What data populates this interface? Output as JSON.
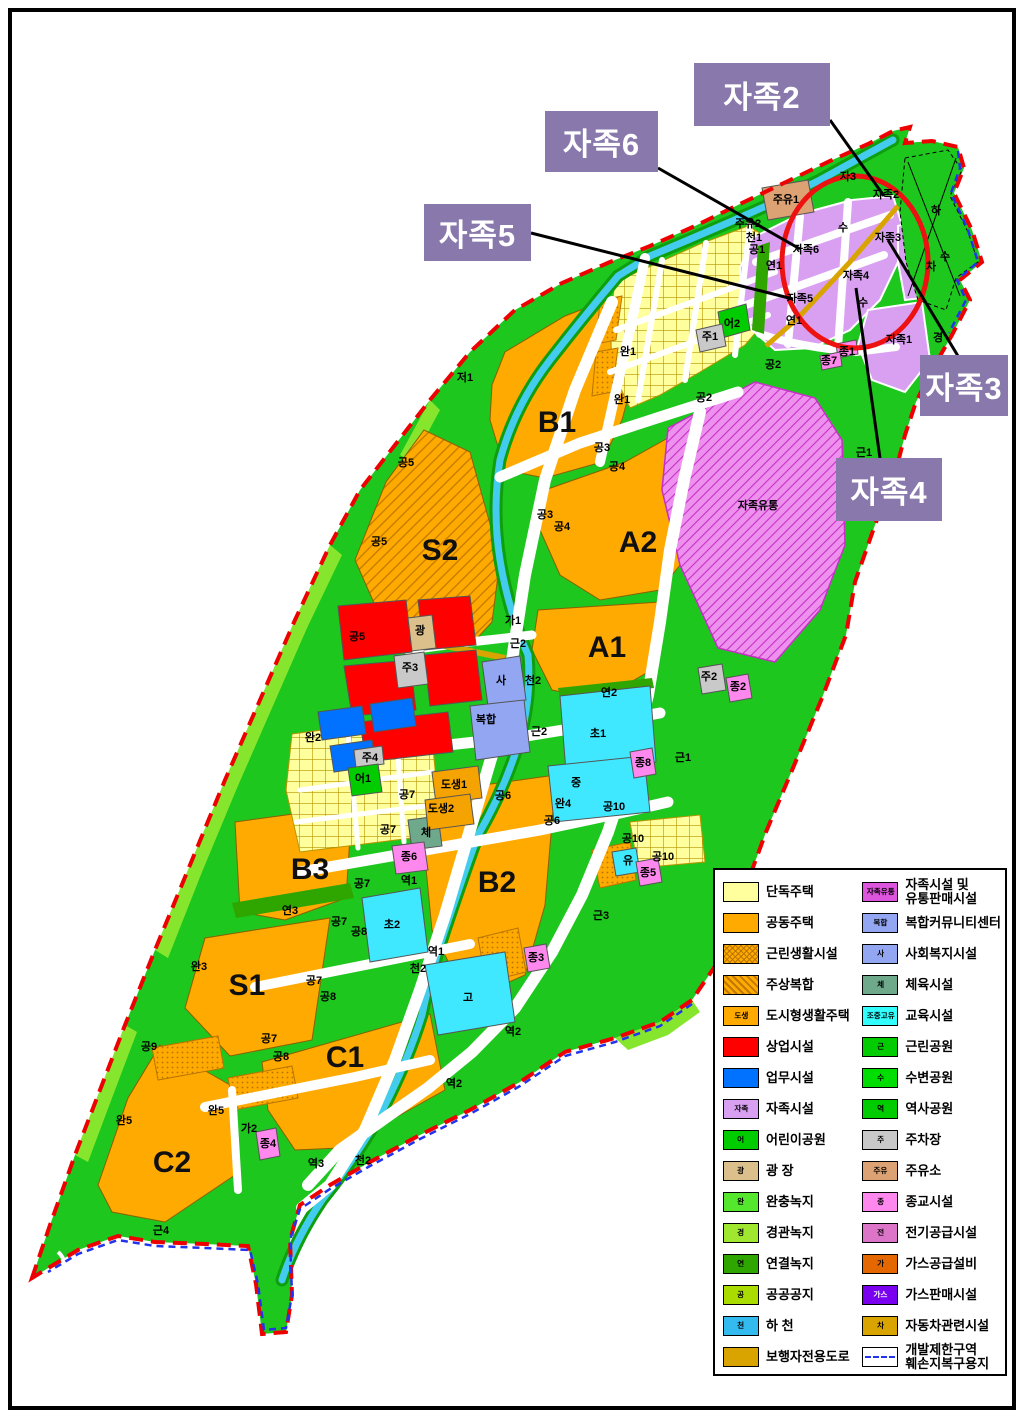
{
  "page": {
    "background": "#FFFFFF",
    "border_color": "#000000"
  },
  "callouts": [
    {
      "label": "자족2"
    },
    {
      "label": "자족6"
    },
    {
      "label": "자족5"
    },
    {
      "label": "자족3"
    },
    {
      "label": "자족4"
    }
  ],
  "map": {
    "colors": {
      "base_green": "#1DC71D",
      "light_green": "#86E62E",
      "orange": "#FFAA00",
      "pale_yellow": "#FFFF9E",
      "commercial_red": "#FF0000",
      "office_blue": "#0072FF",
      "school_cyan": "#3FE8FF",
      "stream_cyan": "#44CCEE",
      "jajok_purple": "#D9A0F2",
      "jajok_magenta": "#DD55DD",
      "community_periwinkle": "#92A6F2",
      "religion_pink": "#FF88EE",
      "plaza_tan": "#DCC08C",
      "gasstation_tan": "#DCA274",
      "parking_gray": "#C9C9C9",
      "gold_road": "#D9A400",
      "sports_teal": "#6FA98C",
      "link_green": "#2FA500",
      "boundary_red": "#EE0000",
      "boundary_blue": "#2233EE",
      "callout_bg": "#8878AC",
      "circle_red": "#EE1111"
    },
    "zone_letters": [
      {
        "t": "B1",
        "x": 557,
        "y": 432
      },
      {
        "t": "A2",
        "x": 638,
        "y": 552
      },
      {
        "t": "A1",
        "x": 607,
        "y": 657
      },
      {
        "t": "S2",
        "x": 440,
        "y": 560
      },
      {
        "t": "B2",
        "x": 497,
        "y": 892
      },
      {
        "t": "B3",
        "x": 310,
        "y": 879
      },
      {
        "t": "S1",
        "x": 247,
        "y": 995
      },
      {
        "t": "C1",
        "x": 345,
        "y": 1067
      },
      {
        "t": "C2",
        "x": 172,
        "y": 1172
      }
    ],
    "labels": [
      {
        "t": "자3",
        "x": 848,
        "y": 180
      },
      {
        "t": "주유1",
        "x": 786,
        "y": 203
      },
      {
        "t": "주유2",
        "x": 748,
        "y": 227
      },
      {
        "t": "천1",
        "x": 754,
        "y": 241
      },
      {
        "t": "공1",
        "x": 757,
        "y": 253
      },
      {
        "t": "하",
        "x": 936,
        "y": 214
      },
      {
        "t": "수",
        "x": 843,
        "y": 231
      },
      {
        "t": "수",
        "x": 945,
        "y": 260
      },
      {
        "t": "차",
        "x": 931,
        "y": 270
      },
      {
        "t": "경",
        "x": 938,
        "y": 341
      },
      {
        "t": "자족2",
        "x": 886,
        "y": 198
      },
      {
        "t": "자족3",
        "x": 888,
        "y": 241
      },
      {
        "t": "자족6",
        "x": 806,
        "y": 253
      },
      {
        "t": "자족4",
        "x": 856,
        "y": 279
      },
      {
        "t": "자족5",
        "x": 800,
        "y": 302
      },
      {
        "t": "자족1",
        "x": 899,
        "y": 343
      },
      {
        "t": "연1",
        "x": 774,
        "y": 269
      },
      {
        "t": "연1",
        "x": 794,
        "y": 324
      },
      {
        "t": "종1",
        "x": 847,
        "y": 355
      },
      {
        "t": "종7",
        "x": 829,
        "y": 364
      },
      {
        "t": "근1",
        "x": 864,
        "y": 456
      },
      {
        "t": "자족유통",
        "x": 758,
        "y": 509
      },
      {
        "t": "저1",
        "x": 465,
        "y": 381
      },
      {
        "t": "완1",
        "x": 628,
        "y": 355
      },
      {
        "t": "완1",
        "x": 622,
        "y": 403
      },
      {
        "t": "공3",
        "x": 602,
        "y": 451
      },
      {
        "t": "공4",
        "x": 617,
        "y": 470
      },
      {
        "t": "공3",
        "x": 545,
        "y": 518
      },
      {
        "t": "공4",
        "x": 562,
        "y": 530
      },
      {
        "t": "공2",
        "x": 773,
        "y": 368
      },
      {
        "t": "공2",
        "x": 704,
        "y": 401
      },
      {
        "t": "주1",
        "x": 710,
        "y": 340
      },
      {
        "t": "어2",
        "x": 732,
        "y": 327
      },
      {
        "t": "공5",
        "x": 406,
        "y": 466
      },
      {
        "t": "공5",
        "x": 379,
        "y": 545
      },
      {
        "t": "공5",
        "x": 357,
        "y": 640
      },
      {
        "t": "광",
        "x": 420,
        "y": 634
      },
      {
        "t": "주3",
        "x": 410,
        "y": 671
      },
      {
        "t": "완2",
        "x": 313,
        "y": 741
      },
      {
        "t": "주4",
        "x": 370,
        "y": 761
      },
      {
        "t": "어1",
        "x": 363,
        "y": 782
      },
      {
        "t": "공7",
        "x": 407,
        "y": 798
      },
      {
        "t": "가1",
        "x": 513,
        "y": 624
      },
      {
        "t": "근2",
        "x": 518,
        "y": 647
      },
      {
        "t": "사",
        "x": 501,
        "y": 684
      },
      {
        "t": "복합",
        "x": 486,
        "y": 723
      },
      {
        "t": "천2",
        "x": 533,
        "y": 684
      },
      {
        "t": "근2",
        "x": 539,
        "y": 735
      },
      {
        "t": "초1",
        "x": 598,
        "y": 737
      },
      {
        "t": "연2",
        "x": 609,
        "y": 696
      },
      {
        "t": "중",
        "x": 576,
        "y": 786
      },
      {
        "t": "종8",
        "x": 643,
        "y": 766
      },
      {
        "t": "근1",
        "x": 683,
        "y": 761
      },
      {
        "t": "도생1",
        "x": 454,
        "y": 788
      },
      {
        "t": "도생2",
        "x": 441,
        "y": 812
      },
      {
        "t": "공6",
        "x": 503,
        "y": 799
      },
      {
        "t": "완4",
        "x": 563,
        "y": 807
      },
      {
        "t": "공6",
        "x": 552,
        "y": 824
      },
      {
        "t": "공10",
        "x": 614,
        "y": 810
      },
      {
        "t": "공10",
        "x": 633,
        "y": 842
      },
      {
        "t": "공10",
        "x": 663,
        "y": 860
      },
      {
        "t": "유",
        "x": 628,
        "y": 864
      },
      {
        "t": "종5",
        "x": 648,
        "y": 876
      },
      {
        "t": "체",
        "x": 426,
        "y": 836
      },
      {
        "t": "종6",
        "x": 409,
        "y": 860
      },
      {
        "t": "공7",
        "x": 388,
        "y": 833
      },
      {
        "t": "공7",
        "x": 362,
        "y": 887
      },
      {
        "t": "역1",
        "x": 409,
        "y": 884
      },
      {
        "t": "초2",
        "x": 392,
        "y": 928
      },
      {
        "t": "근3",
        "x": 601,
        "y": 919
      },
      {
        "t": "종3",
        "x": 536,
        "y": 961
      },
      {
        "t": "역1",
        "x": 436,
        "y": 955
      },
      {
        "t": "천2",
        "x": 418,
        "y": 972
      },
      {
        "t": "고",
        "x": 468,
        "y": 1001
      },
      {
        "t": "공8",
        "x": 359,
        "y": 935
      },
      {
        "t": "공7",
        "x": 339,
        "y": 925
      },
      {
        "t": "연3",
        "x": 290,
        "y": 914
      },
      {
        "t": "완3",
        "x": 199,
        "y": 970
      },
      {
        "t": "공7",
        "x": 314,
        "y": 984
      },
      {
        "t": "공8",
        "x": 328,
        "y": 1000
      },
      {
        "t": "공9",
        "x": 149,
        "y": 1050
      },
      {
        "t": "공7",
        "x": 269,
        "y": 1042
      },
      {
        "t": "공8",
        "x": 281,
        "y": 1060
      },
      {
        "t": "역2",
        "x": 513,
        "y": 1035
      },
      {
        "t": "역2",
        "x": 454,
        "y": 1087
      },
      {
        "t": "완5",
        "x": 216,
        "y": 1114
      },
      {
        "t": "완5",
        "x": 124,
        "y": 1124
      },
      {
        "t": "가2",
        "x": 249,
        "y": 1132
      },
      {
        "t": "종4",
        "x": 268,
        "y": 1147
      },
      {
        "t": "역3",
        "x": 316,
        "y": 1167
      },
      {
        "t": "천2",
        "x": 363,
        "y": 1164
      },
      {
        "t": "근4",
        "x": 161,
        "y": 1234
      },
      {
        "t": "주2",
        "x": 709,
        "y": 680
      },
      {
        "t": "종2",
        "x": 738,
        "y": 690
      },
      {
        "t": "수",
        "x": 863,
        "y": 306
      }
    ]
  },
  "legend": {
    "left": [
      {
        "label": "단독주택",
        "color": "#FFFF9E"
      },
      {
        "label": "공동주택",
        "color": "#FFAA00"
      },
      {
        "label": "근린생활시설",
        "pattern": "pat-dot"
      },
      {
        "label": "주상복합",
        "pattern": "pat-diag"
      },
      {
        "label": "도시형생활주택",
        "color": "#FFAA00",
        "chip": "도생"
      },
      {
        "label": "상업시설",
        "color": "#FF0000"
      },
      {
        "label": "업무시설",
        "color": "#0072FF"
      },
      {
        "label": "자족시설",
        "color": "#D9A0F2",
        "chip": "자족"
      },
      {
        "label": "어린이공원",
        "color": "#00CC00",
        "chip": "어"
      },
      {
        "label": "광 장",
        "color": "#DCC08C",
        "chip": "광"
      },
      {
        "label": "완충녹지",
        "color": "#55E62E",
        "chip": "완"
      },
      {
        "label": "경관녹지",
        "color": "#A0E830",
        "chip": "경"
      },
      {
        "label": "연결녹지",
        "color": "#2FA500",
        "chip": "연"
      },
      {
        "label": "공공공지",
        "color": "#AADC00",
        "chip": "공"
      },
      {
        "label": "하 천",
        "color": "#33BBF0",
        "chip": "천"
      },
      {
        "label": "보행자전용도로",
        "color": "#D9A400"
      }
    ],
    "right": [
      {
        "label": "자족시설 및",
        "label2": "유통판매시설",
        "color": "#DD55DD",
        "chip": "자족유통"
      },
      {
        "label": "복합커뮤니티센터",
        "color": "#92A6F2",
        "chip": "복합"
      },
      {
        "label": "사회복지시설",
        "color": "#92A6F2",
        "chip": "사"
      },
      {
        "label": "체육시설",
        "color": "#6FA98C",
        "chip": "체"
      },
      {
        "label": "교육시설",
        "color": "#33FFFF",
        "chip": "조중고유"
      },
      {
        "label": "근린공원",
        "color": "#00CC00",
        "chip": "근"
      },
      {
        "label": "수변공원",
        "color": "#00DD00",
        "chip": "수"
      },
      {
        "label": "역사공원",
        "color": "#00CC00",
        "chip": "역"
      },
      {
        "label": "주차장",
        "color": "#C9C9C9",
        "chip": "주"
      },
      {
        "label": "주유소",
        "color": "#DCA274",
        "chip": "주유"
      },
      {
        "label": "종교시설",
        "color": "#FF88EE",
        "chip": "종"
      },
      {
        "label": "전기공급시설",
        "color": "#DC74C8",
        "chip": "전"
      },
      {
        "label": "가스공급설비",
        "color": "#E56700",
        "chip": "가"
      },
      {
        "label": "가스판매시설",
        "color": "#7A00F0",
        "chip": "가스",
        "chip_white": true
      },
      {
        "label": "자동차관련시설",
        "color": "#D9A400",
        "chip": "차"
      },
      {
        "label": "개발제한구역",
        "label2": "훼손지복구용지",
        "pattern": "pat-dash"
      }
    ]
  }
}
